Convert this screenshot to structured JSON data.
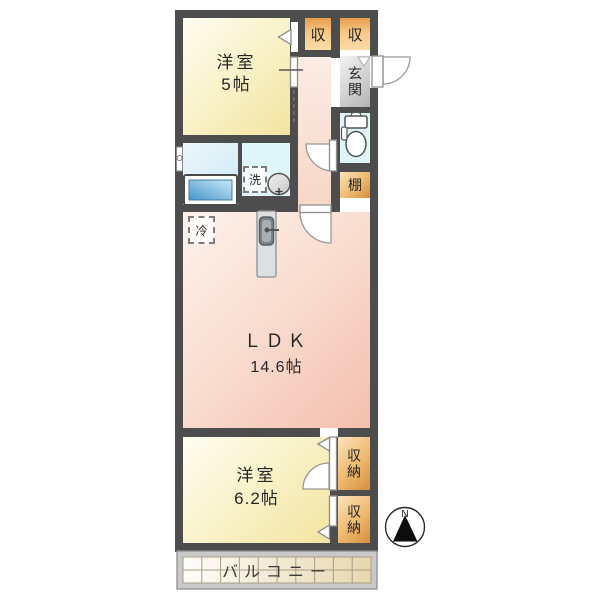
{
  "rooms": {
    "bedroom1": {
      "name": "洋室",
      "size": "5帖"
    },
    "bedroom2": {
      "name": "洋室",
      "size": "6.2帖"
    },
    "ldk": {
      "name": "ＬＤＫ",
      "size": "14.6帖"
    },
    "entrance": {
      "label": "玄関"
    }
  },
  "storage": {
    "closet_top_left": "収",
    "closet_top_right": "収",
    "shelf": "棚",
    "storage_upper": "収納",
    "storage_lower": "収納"
  },
  "fixtures": {
    "washer_label": "洗",
    "fridge_label": "冷"
  },
  "balcony": {
    "label": "バルコニー"
  },
  "compass": {
    "label": "N"
  },
  "colors": {
    "wall": "#4d4d4d",
    "room_yellow": "#f2e49f",
    "ldk_pink": "#f4bfad",
    "closet_orange": "#d68f3c",
    "water_blue": "#cfe8f5",
    "entrance_gray": "#b2b2b2",
    "bathtub_blue": "#4795ca"
  }
}
